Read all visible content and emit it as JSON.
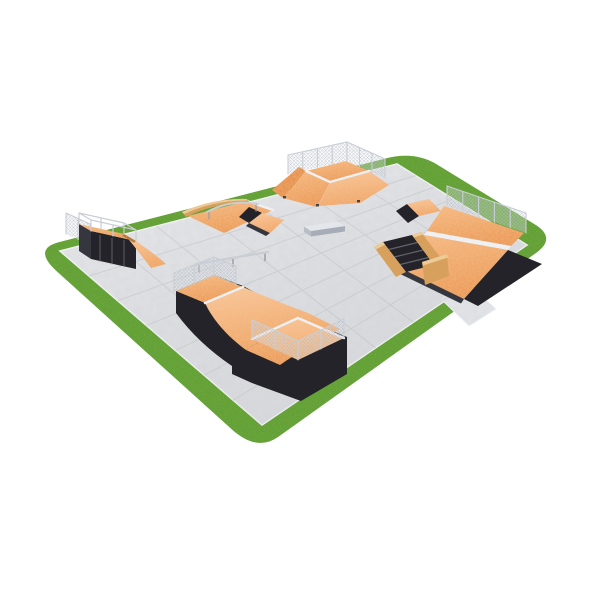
{
  "scene": {
    "subject": "3D render of a modular skatepark on a tiled concrete pad surrounded by a rounded grass border",
    "elements": [
      {
        "id": "grass-border",
        "label": "grass border"
      },
      {
        "id": "concrete-pad",
        "label": "tiled concrete pad"
      },
      {
        "id": "entry-walkway",
        "label": "entry walkway"
      },
      {
        "id": "kicker-funbox",
        "label": "kicker funbox with safety fence"
      },
      {
        "id": "funbox-grind-unit",
        "label": "funbox with grind ledge and rail"
      },
      {
        "id": "quarter-pipe-left",
        "label": "quarter pipe with deck guardrail"
      },
      {
        "id": "grind-ledge",
        "label": "low grind ledge"
      },
      {
        "id": "flat-rail",
        "label": "flat grind rail"
      },
      {
        "id": "bank-ramp-right",
        "label": "bank ramp with stairs and wooden rails"
      },
      {
        "id": "mini-ramp",
        "label": "mini ramp with fenced decks"
      }
    ]
  },
  "colors": {
    "background": "#ffffff",
    "grass": "#64a335",
    "grass_shadow": "#3f7a1e",
    "concrete": "#e1e3e6",
    "concrete_line": "#c2c4c8",
    "concrete_edge": "#f2f3f5",
    "ramp": "#f1a76d",
    "ramp_light": "#f7c394",
    "ramp_dark": "#e6924f",
    "side": "#232329",
    "side_light": "#36363e",
    "wood": "#d7a05c",
    "wood_light": "#edcb96",
    "wood_dark": "#b67c3e",
    "metal": "#c9ced5",
    "metal_dark": "#959ca6",
    "mesh": "#b3bac4",
    "band": "#eef0f3"
  }
}
